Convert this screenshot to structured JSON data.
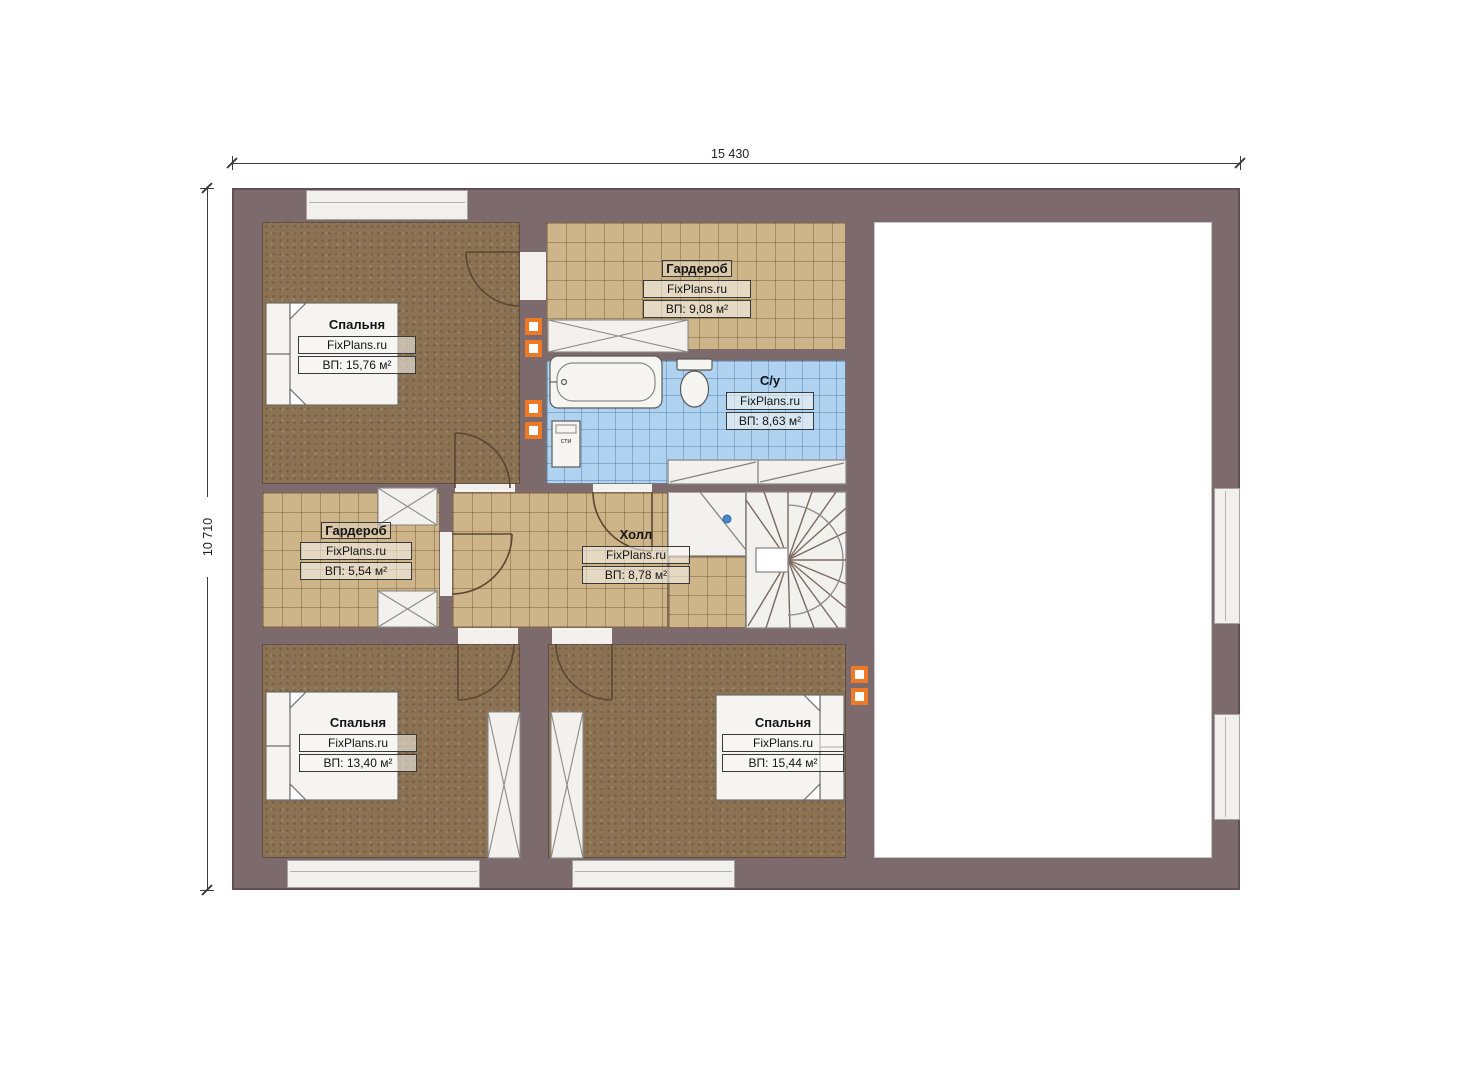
{
  "dimensions": {
    "width_label": "15 430",
    "height_label": "10 710"
  },
  "watermark": "FixPlans.ru",
  "rooms": [
    {
      "id": "bedroom-top-left",
      "name": "Спальня",
      "area": "ВП: 15,76 м²"
    },
    {
      "id": "wardrobe-top",
      "name": "Гардероб",
      "area": "ВП: 9,08 м²"
    },
    {
      "id": "bathroom",
      "name": "С/у",
      "area": "ВП: 8,63 м²"
    },
    {
      "id": "wardrobe-middle",
      "name": "Гардероб",
      "area": "ВП: 5,54 м²"
    },
    {
      "id": "hall",
      "name": "Холл",
      "area": "ВП: 8,78 м²"
    },
    {
      "id": "bedroom-bottom-left",
      "name": "Спальня",
      "area": "ВП: 13,40 м²"
    },
    {
      "id": "bedroom-bottom-right",
      "name": "Спальня",
      "area": "ВП: 15,44 м²"
    }
  ],
  "fixtures": {
    "washer_label": "сти"
  },
  "colors": {
    "wall": "#7d6a6d",
    "bedroom_floor": "#8b7253",
    "tile_floor": "#cdb489",
    "bathroom_floor": "#aed2f0",
    "vent_orange": "#ee7a28",
    "stair_white": "#f2f1ee"
  }
}
